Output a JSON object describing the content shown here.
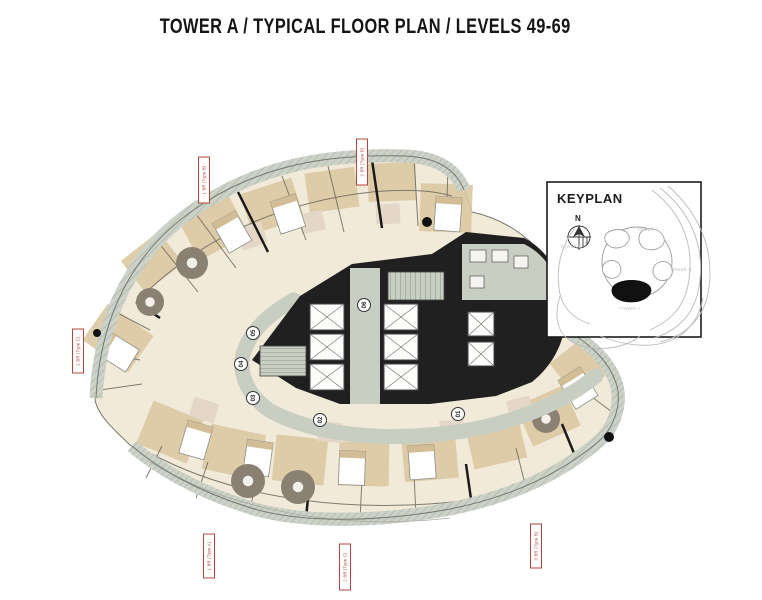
{
  "page": {
    "title": "TOWER A / TYPICAL FLOOR PLAN / LEVELS 49-69"
  },
  "keyplan": {
    "title": "KEYPLAN",
    "north_label": "N",
    "towers": [
      {
        "name": "TOWER C",
        "highlighted": false
      },
      {
        "name": "TOWER B",
        "highlighted": false
      },
      {
        "name": "TOWER D",
        "highlighted": false
      },
      {
        "name": "TOWER A",
        "highlighted": true
      }
    ],
    "highlighted_tower": "TOWER A"
  },
  "floor_plan": {
    "unit_badges": [
      {
        "number": "01"
      },
      {
        "number": "02"
      },
      {
        "number": "03"
      },
      {
        "number": "04"
      },
      {
        "number": "05"
      },
      {
        "number": "06"
      }
    ],
    "unit_type_tags": [
      {
        "text": "1 BR (Type B)",
        "position": "top-left"
      },
      {
        "text": "2 BR (Type B)",
        "position": "top-middle"
      },
      {
        "text": "1 BR (Type C)",
        "position": "left"
      },
      {
        "text": "1 BR (Type A)",
        "position": "bottom-left"
      },
      {
        "text": "2 BR (Type C)",
        "position": "bottom-middle"
      },
      {
        "text": "3 BR (Type B)",
        "position": "bottom-right"
      }
    ],
    "colors": {
      "tag_red": "#b5453a",
      "core_black": "#202020",
      "corridor_green": "#c8cec2",
      "room_cream": "#f1ead9",
      "room_tan": "#dcc9a4",
      "rug_brown": "#8b8173",
      "balcony_band": "#ccd2c7"
    }
  }
}
